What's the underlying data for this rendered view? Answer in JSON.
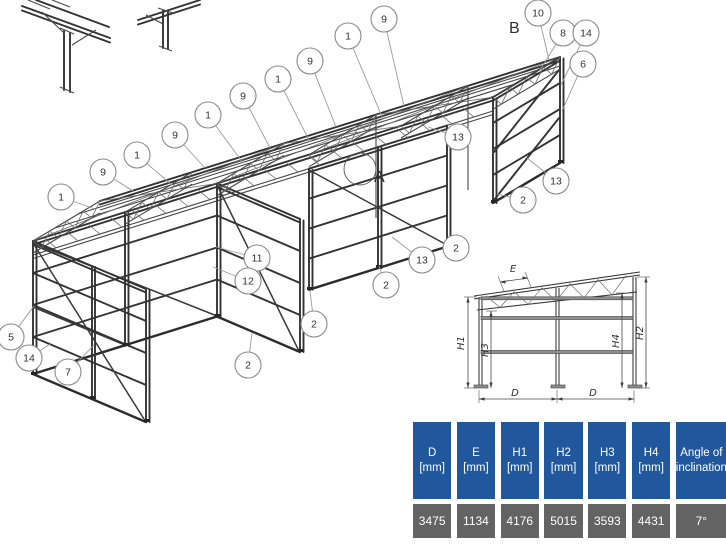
{
  "drawing": {
    "view_labels": [
      {
        "label": "B",
        "x": 509,
        "y": 33
      },
      {
        "label": "A",
        "x": 374,
        "y": 182
      }
    ],
    "callouts": [
      {
        "label": "9",
        "cx": 384,
        "cy": 19,
        "lx": 404,
        "ly": 106
      },
      {
        "label": "1",
        "cx": 348,
        "cy": 36,
        "lx": 383,
        "ly": 119
      },
      {
        "label": "9",
        "cx": 310,
        "cy": 61,
        "lx": 336,
        "ly": 127
      },
      {
        "label": "1",
        "cx": 278,
        "cy": 79,
        "lx": 310,
        "ly": 142
      },
      {
        "label": "9",
        "cx": 243,
        "cy": 96,
        "lx": 270,
        "ly": 148
      },
      {
        "label": "1",
        "cx": 208,
        "cy": 115,
        "lx": 243,
        "ly": 163
      },
      {
        "label": "9",
        "cx": 175,
        "cy": 135,
        "lx": 205,
        "ly": 168
      },
      {
        "label": "1",
        "cx": 137,
        "cy": 155,
        "lx": 172,
        "ly": 185
      },
      {
        "label": "9",
        "cx": 103,
        "cy": 172,
        "lx": 133,
        "ly": 191
      },
      {
        "label": "1",
        "cx": 61,
        "cy": 197,
        "lx": 95,
        "ly": 209
      },
      {
        "label": "10",
        "cx": 538,
        "cy": 13,
        "lx": 549,
        "ly": 60
      },
      {
        "label": "8",
        "cx": 563,
        "cy": 33,
        "lx": 540,
        "ly": 70
      },
      {
        "label": "14",
        "cx": 586,
        "cy": 33,
        "lx": 561,
        "ly": 85
      },
      {
        "label": "6",
        "cx": 583,
        "cy": 64,
        "lx": 562,
        "ly": 111
      },
      {
        "label": "13",
        "cx": 458,
        "cy": 137,
        "lx": 428,
        "ly": 127
      },
      {
        "label": "13",
        "cx": 556,
        "cy": 181,
        "lx": 527,
        "ly": 158
      },
      {
        "label": "2",
        "cx": 523,
        "cy": 200,
        "lx": 497,
        "ly": 194
      },
      {
        "label": "11",
        "cx": 257,
        "cy": 258,
        "lx": 216,
        "ly": 247
      },
      {
        "label": "12",
        "cx": 248,
        "cy": 281,
        "lx": 213,
        "ly": 267
      },
      {
        "label": "2",
        "cx": 456,
        "cy": 248,
        "lx": 448,
        "ly": 244
      },
      {
        "label": "13",
        "cx": 422,
        "cy": 260,
        "lx": 392,
        "ly": 237
      },
      {
        "label": "2",
        "cx": 386,
        "cy": 285,
        "lx": 379,
        "ly": 266
      },
      {
        "label": "2",
        "cx": 314,
        "cy": 324,
        "lx": 310,
        "ly": 291
      },
      {
        "label": "2",
        "cx": 248,
        "cy": 365,
        "lx": 252,
        "ly": 333
      },
      {
        "label": "5",
        "cx": 11,
        "cy": 337,
        "lx": 34,
        "ly": 306
      },
      {
        "label": "14",
        "cx": 29,
        "cy": 358,
        "lx": 50,
        "ly": 344
      },
      {
        "label": "7",
        "cx": 68,
        "cy": 372,
        "lx": 94,
        "ly": 345
      }
    ],
    "elevation_labels": [
      {
        "label": "E",
        "x": 513,
        "y": 272,
        "rotate": 0
      },
      {
        "label": "H1",
        "x": 464,
        "y": 343,
        "rotate": -90
      },
      {
        "label": "H3",
        "x": 488,
        "y": 350,
        "rotate": -90
      },
      {
        "label": "H4",
        "x": 619,
        "y": 341,
        "rotate": -90
      },
      {
        "label": "H2",
        "x": 643,
        "y": 333,
        "rotate": -90
      },
      {
        "label": "D",
        "x": 515,
        "y": 396,
        "rotate": 0
      },
      {
        "label": "D",
        "x": 593,
        "y": 396,
        "rotate": 0
      }
    ]
  },
  "table": {
    "header_bg": "#20579d",
    "value_bg": "#636363",
    "text_color": "#ffffff",
    "columns": [
      {
        "header_line1": "D",
        "header_line2": "[mm]",
        "value": "3475"
      },
      {
        "header_line1": "E",
        "header_line2": "[mm]",
        "value": "1134"
      },
      {
        "header_line1": "H1",
        "header_line2": "[mm]",
        "value": "4176"
      },
      {
        "header_line1": "H2",
        "header_line2": "[mm]",
        "value": "5015"
      },
      {
        "header_line1": "H3",
        "header_line2": "[mm]",
        "value": "3593"
      },
      {
        "header_line1": "H4",
        "header_line2": "[mm]",
        "value": "4431"
      },
      {
        "header_line1": "Angle of",
        "header_line2": "inclination",
        "value": "7°"
      }
    ]
  }
}
